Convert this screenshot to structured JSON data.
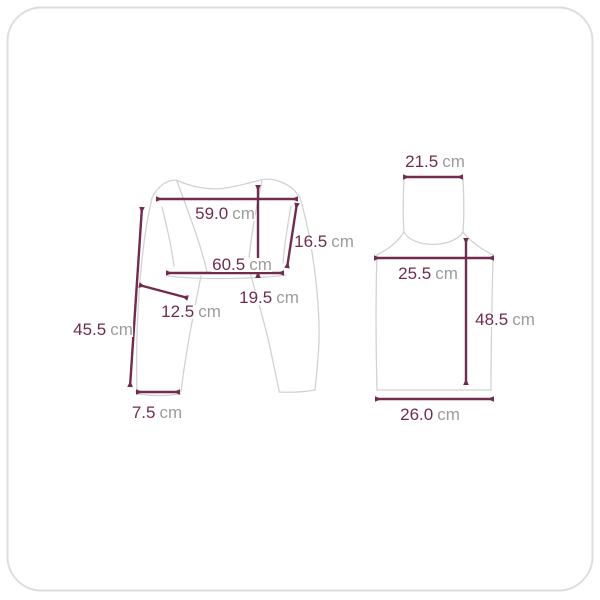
{
  "colors": {
    "dimension_line": "#722b4f",
    "value_text": "#722b4f",
    "unit_text": "#9c9c9c",
    "garment_outline": "#d2d2d2",
    "frame_border": "#dedede",
    "background": "#ffffff"
  },
  "measurements": {
    "shrug": {
      "shoulder_width": {
        "value": "59.0",
        "unit": "cm"
      },
      "side_length": {
        "value": "16.5",
        "unit": "cm"
      },
      "hem_width": {
        "value": "60.5",
        "unit": "cm"
      },
      "center_length": {
        "value": "19.5",
        "unit": "cm"
      },
      "sleeve_width": {
        "value": "12.5",
        "unit": "cm"
      },
      "sleeve_length": {
        "value": "45.5",
        "unit": "cm"
      },
      "cuff_width": {
        "value": "7.5",
        "unit": "cm"
      }
    },
    "tank": {
      "neck_width": {
        "value": "21.5",
        "unit": "cm"
      },
      "chest_width": {
        "value": "25.5",
        "unit": "cm"
      },
      "total_length": {
        "value": "48.5",
        "unit": "cm"
      },
      "hem_width": {
        "value": "26.0",
        "unit": "cm"
      }
    }
  }
}
